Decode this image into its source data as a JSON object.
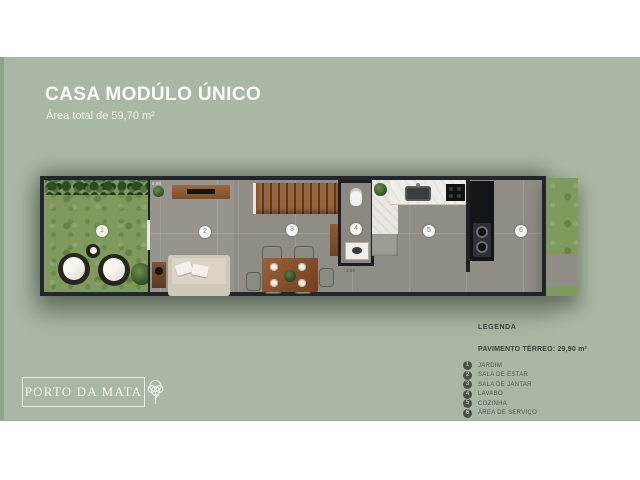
{
  "slide": {
    "title": "CASA MODÚLO ÚNICO",
    "subtitle": "Área total de 59,70 m²"
  },
  "plan": {
    "room_markers": [
      "1",
      "2",
      "3",
      "4",
      "5",
      "6"
    ],
    "dimension_labels": {
      "living_width": "5,80",
      "hall_width": "1,00"
    }
  },
  "legend": {
    "heading": "LEGENDA",
    "floor_title": "PAVIMENTO TÉRREO: 29,90 m²",
    "items": [
      {
        "number": "1",
        "label": "JARDIM"
      },
      {
        "number": "2",
        "label": "SALA DE ESTAR"
      },
      {
        "number": "3",
        "label": "SALA DE JANTAR"
      },
      {
        "number": "4",
        "label": "LAVABO"
      },
      {
        "number": "5",
        "label": "COZINHA"
      },
      {
        "number": "6",
        "label": "ÁREA DE SERVIÇO"
      }
    ]
  },
  "brand": {
    "name": "PORTO DA MATA"
  },
  "colors": {
    "background": "#a9b8a4",
    "wall": "#23262b",
    "grass": "#7f9a5c"
  }
}
